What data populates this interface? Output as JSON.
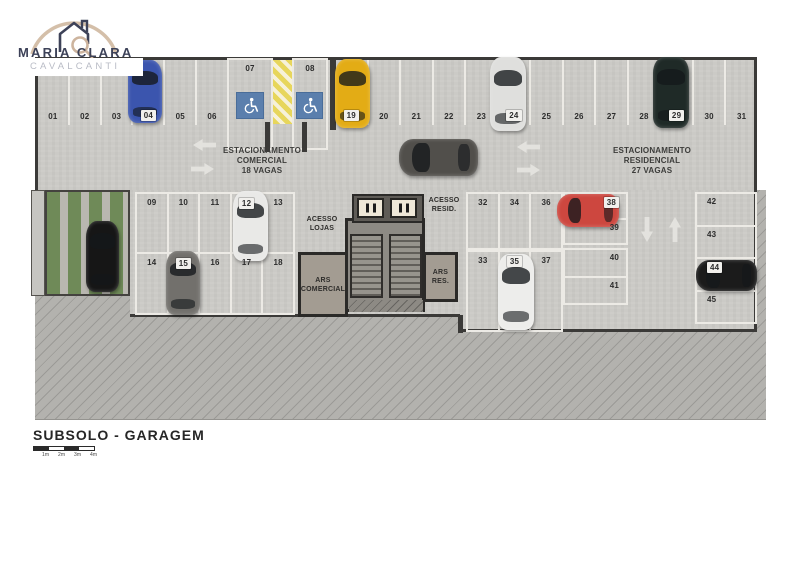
{
  "logo": {
    "name": "MARIA CLARA",
    "subname": "CAVALCANTI"
  },
  "plan": {
    "zones": {
      "commercial_label": "ESTACIONAMENTO\nCOMERCIAL\n18 VAGAS",
      "residential_label": "ESTACIONAMENTO\nRESIDENCIAL\n27 VAGAS",
      "access_shops": "ACESSO\nLOJAS",
      "access_residential": "ACESSO\nRESID.",
      "ars_commercial": "ARS\nCOMERCIAL",
      "ars_residential": "ARS\nRES."
    },
    "spaces": {
      "top_left": [
        "01",
        "02",
        "03",
        "04",
        "05",
        "06"
      ],
      "accessible": [
        "07",
        "08"
      ],
      "top_right": [
        "19",
        "20",
        "21",
        "22",
        "23",
        "24",
        "25",
        "26",
        "27",
        "28",
        "29",
        "30",
        "31"
      ],
      "mid_top": [
        "09",
        "10",
        "11",
        "12",
        "13"
      ],
      "mid_bottom": [
        "14",
        "15",
        "16",
        "17",
        "18"
      ],
      "res_top": [
        "32",
        "34",
        "36"
      ],
      "res_bottom": [
        "33",
        "35",
        "37"
      ],
      "res_side_top": [
        "38",
        "39"
      ],
      "res_side_bottom": [
        "40",
        "41"
      ],
      "right_column": [
        "42",
        "43",
        "44",
        "45"
      ]
    },
    "cars": [
      {
        "space": "04",
        "color": "#3b55ae"
      },
      {
        "space": "12",
        "color": "#e9e9e7"
      },
      {
        "space": "15",
        "color": "#72706c"
      },
      {
        "space": "19",
        "color": "#e3ac15"
      },
      {
        "space": "24",
        "color": "#dfdfdd"
      },
      {
        "space": "29",
        "color": "#1f2a27"
      },
      {
        "space": "35",
        "color": "#ededeb"
      },
      {
        "space": "38",
        "color": "#cd473f"
      },
      {
        "space": "44",
        "color": "#1b1b1b"
      },
      {
        "space": "driveway",
        "color": "#514f4b"
      },
      {
        "space": "ramp",
        "color": "#161616"
      }
    ],
    "palette": {
      "concrete": "#cbcac6",
      "hatch_area": "#b3b2ae",
      "accessible_blue": "#5b7fad",
      "hazard_yellow": "#e7d65c",
      "grass_green": "#6f8a58",
      "wall_dark": "#3b3a38",
      "line_white": "#eceae5"
    }
  },
  "footer": {
    "title": "SUBSOLO - GARAGEM",
    "scale_labels": [
      "1m",
      "2m",
      "3m",
      "4m"
    ]
  }
}
